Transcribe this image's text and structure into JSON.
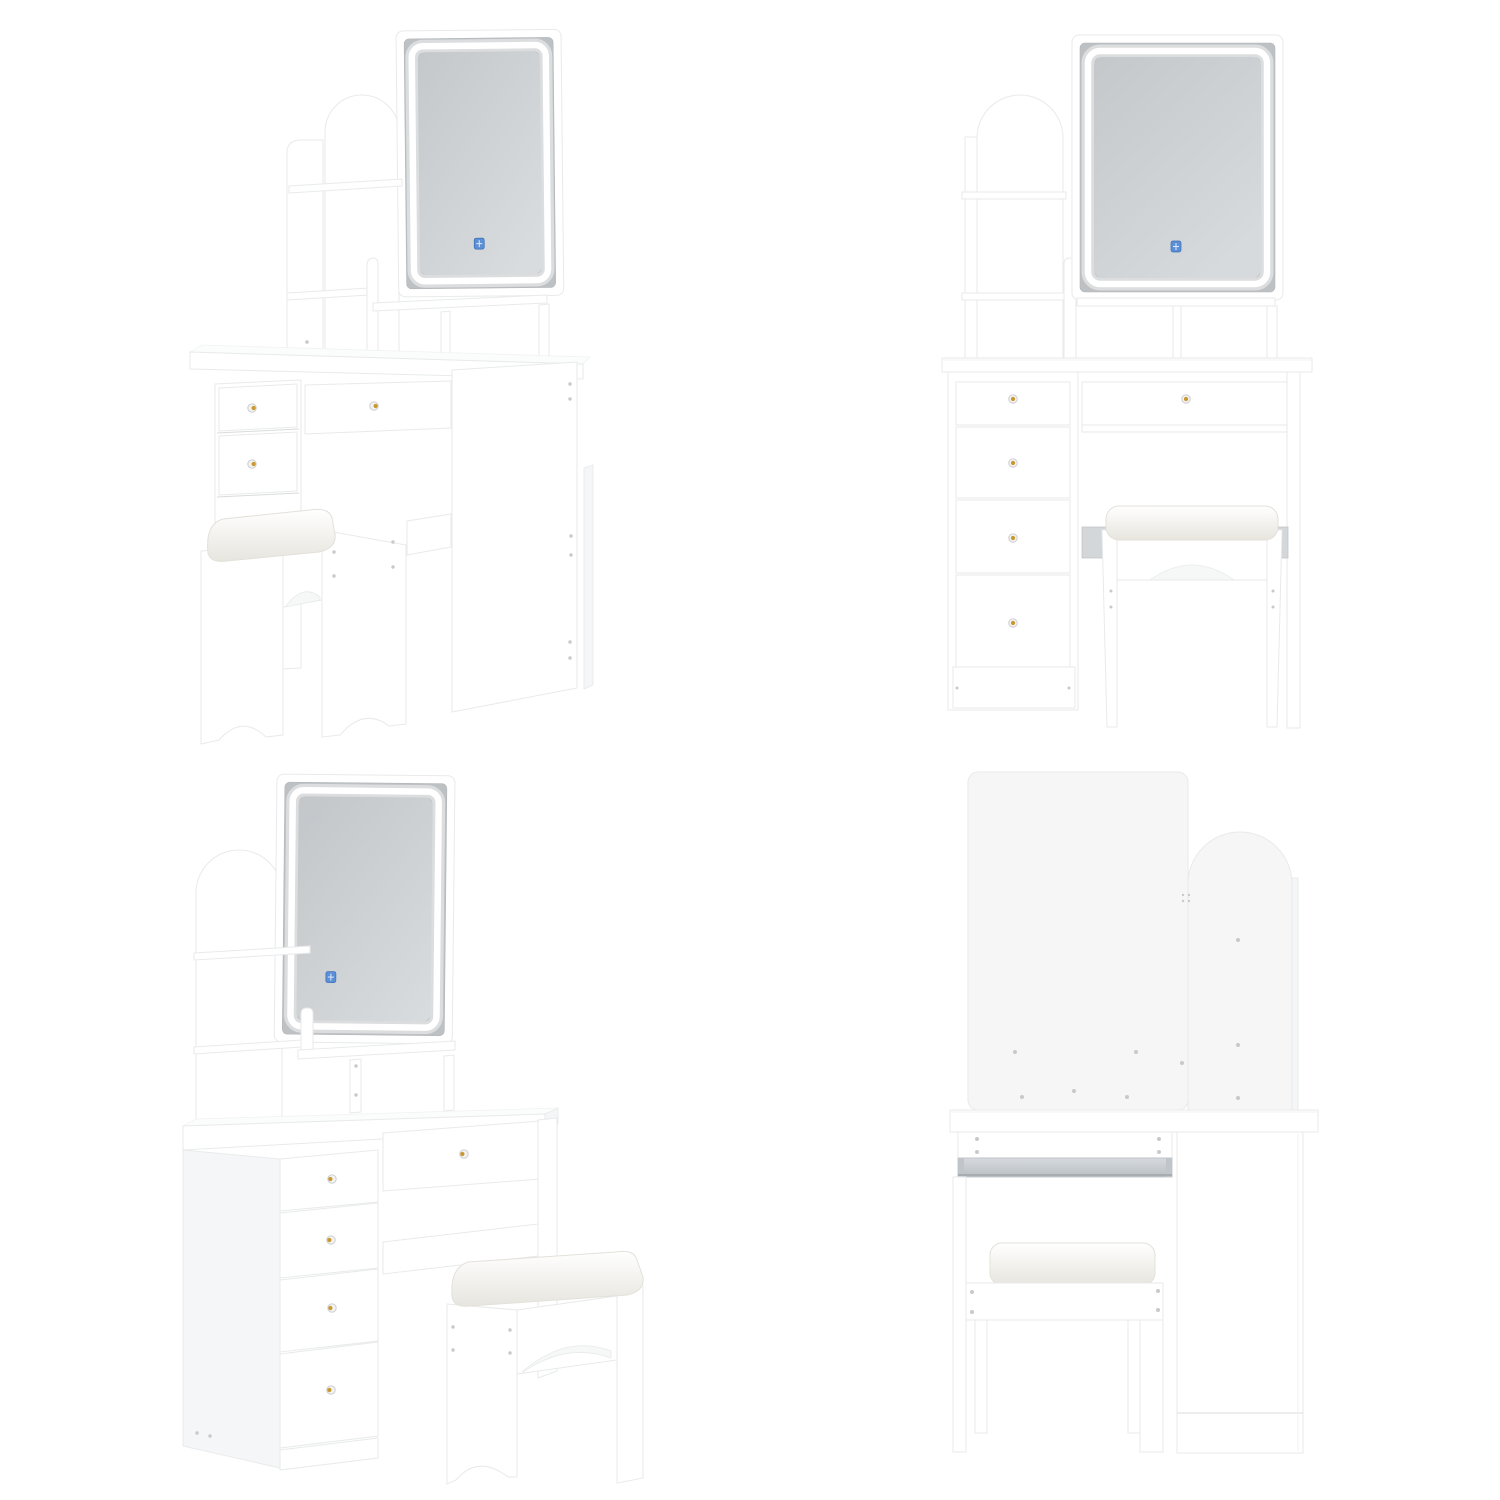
{
  "background": "#ffffff",
  "layout": {
    "grid": "2x2",
    "cell_size": "750x750"
  },
  "colors": {
    "white": "#ffffff",
    "edge": "#e8eaeb",
    "edge_soft": "#f1f2f3",
    "tint": "#f5f6f7",
    "backpanel": "#f6f6f7",
    "seam": "#d9dbdc",
    "bezel": "#bdc1c3",
    "glass_dark": "#c4c8cb",
    "glass_light": "#d8dcde",
    "led": "#ffffff",
    "touch_blue": "#5b8fd6",
    "touch_blue_dark": "#3e6db6",
    "gold": "#c9992e",
    "screw": "#c6cacc",
    "stretcher": "#d3d7d9",
    "rail_metal_light": "#d6dade",
    "rail_metal_dark": "#b9bfc4",
    "rail_shadow": "#9fa5a9",
    "cushion_light": "#ffffff",
    "cushion_shade": "#e7e5de",
    "cushion_edge": "#e3e1da"
  },
  "views": [
    {
      "id": "angled-right",
      "position": "top-left",
      "label": "vanity set angled view from right"
    },
    {
      "id": "front",
      "position": "top-right",
      "label": "vanity set front view"
    },
    {
      "id": "angled-left",
      "position": "bottom-left",
      "label": "vanity set angled view from left"
    },
    {
      "id": "back",
      "position": "bottom-right",
      "label": "vanity set back view"
    }
  ],
  "product_parts": {
    "mirror": {
      "type": "rectangular LED mirror",
      "led_ring": true,
      "touch_button_color": "#5b8fd6"
    },
    "hutch": {
      "arched_back_panel": true,
      "open_shelves": 2,
      "tabletop_cubbies": 2
    },
    "drawers": {
      "side_drawers": 4,
      "top_drawer": 1,
      "knob_color": "#c9992e"
    },
    "stool": {
      "cushioned_seat": true,
      "arched_cutouts": true
    },
    "hardware": {
      "screws_visible": true,
      "metal_drawer_slide_visible_in_back_view": true
    }
  }
}
